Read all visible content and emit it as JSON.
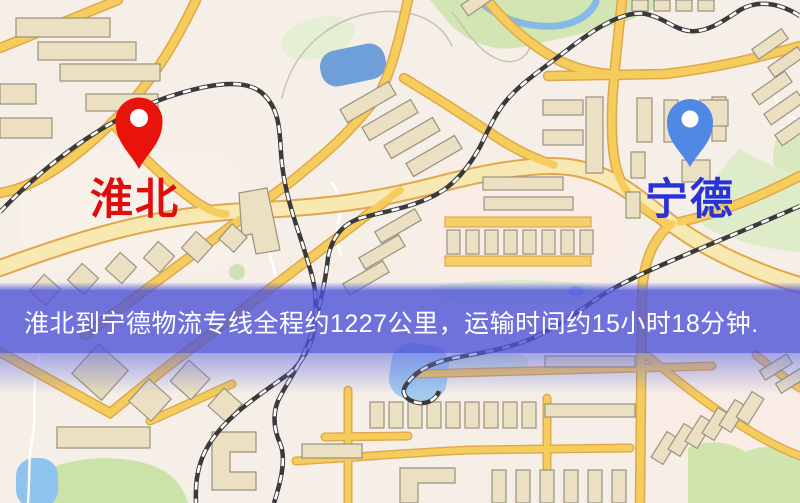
{
  "map": {
    "banner": {
      "text": "淮北到宁德物流专线全程约1227公里，运输时间约15小时18分钟.",
      "distance_text": "约1227公里",
      "duration_text": "约15小时18分钟",
      "background": "rgba(77,83,216,0.80)",
      "text_color": "#ffffff"
    },
    "markers": {
      "origin": {
        "label": "淮北",
        "pin_color": "#e8140c",
        "label_color": "#e00d0d"
      },
      "destination": {
        "label": "宁德",
        "pin_color": "#5089e4",
        "label_color": "#2a31d8"
      }
    },
    "colors": {
      "land": "#f5efe7",
      "road": "#f5cd5d",
      "road_casing": "#e2a64b",
      "arterial": "#f8e9b2",
      "park": "#d2e5b2",
      "water": "#6f9fd8",
      "building": "#ebe1c2",
      "railway": "#3a3a3a"
    }
  }
}
